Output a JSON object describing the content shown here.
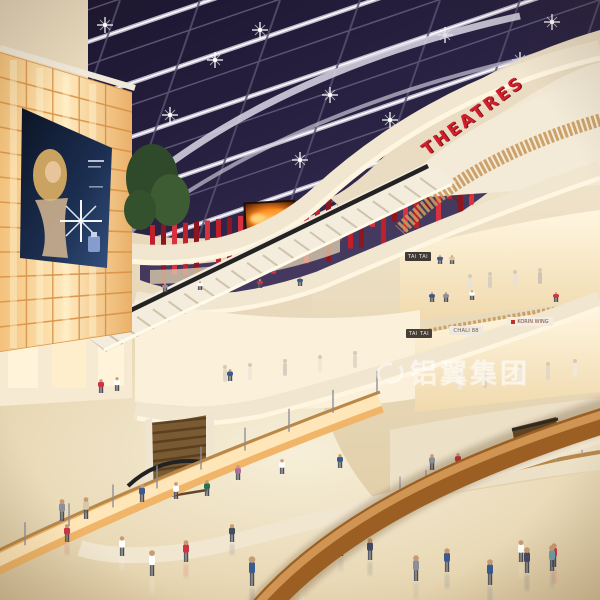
{
  "signs": {
    "theatres": "THEATRES",
    "tai_tai_upper": "TAI TAI",
    "tai_tai_lower": "TAI TAI",
    "chali88": "CHALI 88",
    "korin_wing": "KORIN WING"
  },
  "watermark": {
    "text": "铝翼集团",
    "logo_icon": "swirl-logo",
    "color": "#ffffff",
    "opacity": 0.55
  },
  "icons": {
    "ceiling_lights": "starburst-light-icon",
    "billboard_sparkle": "sparkle-icon"
  },
  "colors": {
    "theatres_red": "#c8202e",
    "red_slats": "#b51e28",
    "skylight_glass": "#2a2344",
    "structure_white": "#ddd8e6",
    "fascia_cream": "#f2e8d4",
    "cove_light": "#fff7e2",
    "luminous_wall_amber": "#ffe3a8",
    "wood_rib": "#c08b4f",
    "wood_handrail": "#9c5f23",
    "floor_marble": "#e8d9ba",
    "store_glow": "#fff1d4",
    "led_screen_flame": "#ff8a1e",
    "billboard_dark": "#101a2c"
  }
}
